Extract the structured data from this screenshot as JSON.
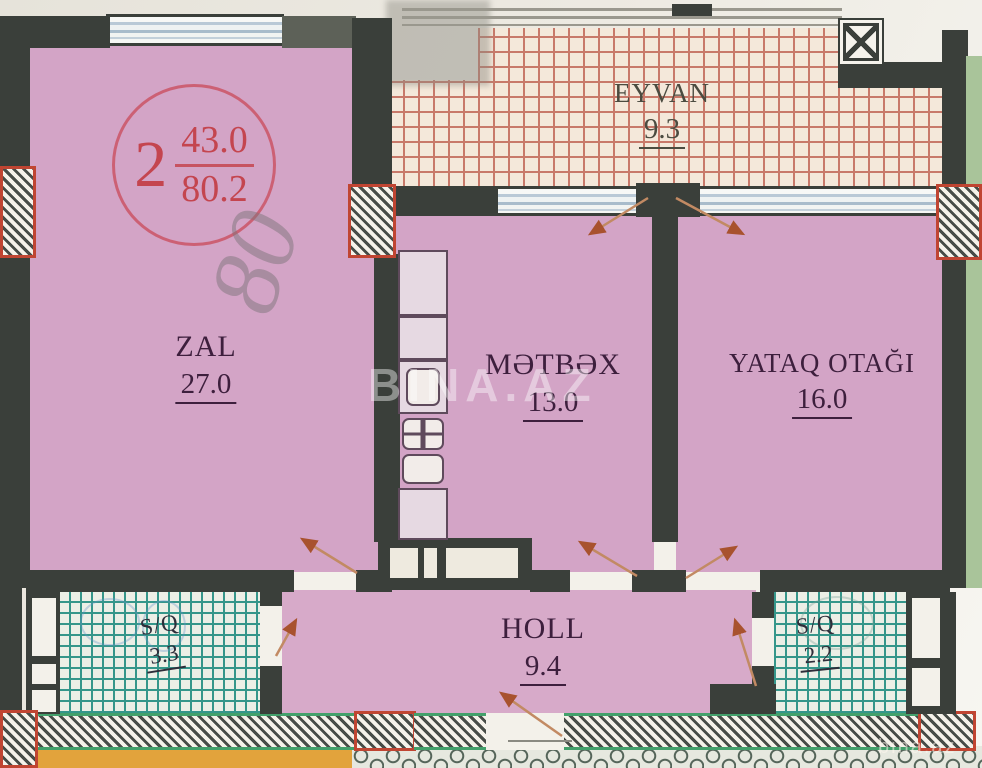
{
  "plan": {
    "stamp": {
      "unit_number": "2",
      "area_living": "43.0",
      "area_total": "80.2"
    },
    "pencil_note": "80",
    "rooms": [
      {
        "id": "zal",
        "name": "ZAL",
        "area": "27.0"
      },
      {
        "id": "metbex",
        "name": "MƏTBƏX",
        "area": "13.0"
      },
      {
        "id": "yataq",
        "name": "YATAQ OTAĞI",
        "area": "16.0"
      },
      {
        "id": "eyvan",
        "name": "EYVAN",
        "area": "9.3"
      },
      {
        "id": "holl",
        "name": "HOLL",
        "area": "9.4"
      },
      {
        "id": "sq-left",
        "name": "S/Q",
        "area": "3.3"
      },
      {
        "id": "sq-right",
        "name": "S/Q",
        "area": "2.2"
      }
    ],
    "watermark_center": "BINA.AZ",
    "watermark_corner": "bina.az",
    "colors": {
      "wall": "#3a3f3a",
      "room_fill": "#d3a4c6",
      "balcony_grid": "#c8796a",
      "wet_room_grid": "#35968a",
      "stamp_red": "#c4454f",
      "door_arrow": "#c28a63",
      "orange_strip": "#e2a33c",
      "green_border": "#43a06b",
      "column_hatch_border": "#c04532"
    }
  }
}
